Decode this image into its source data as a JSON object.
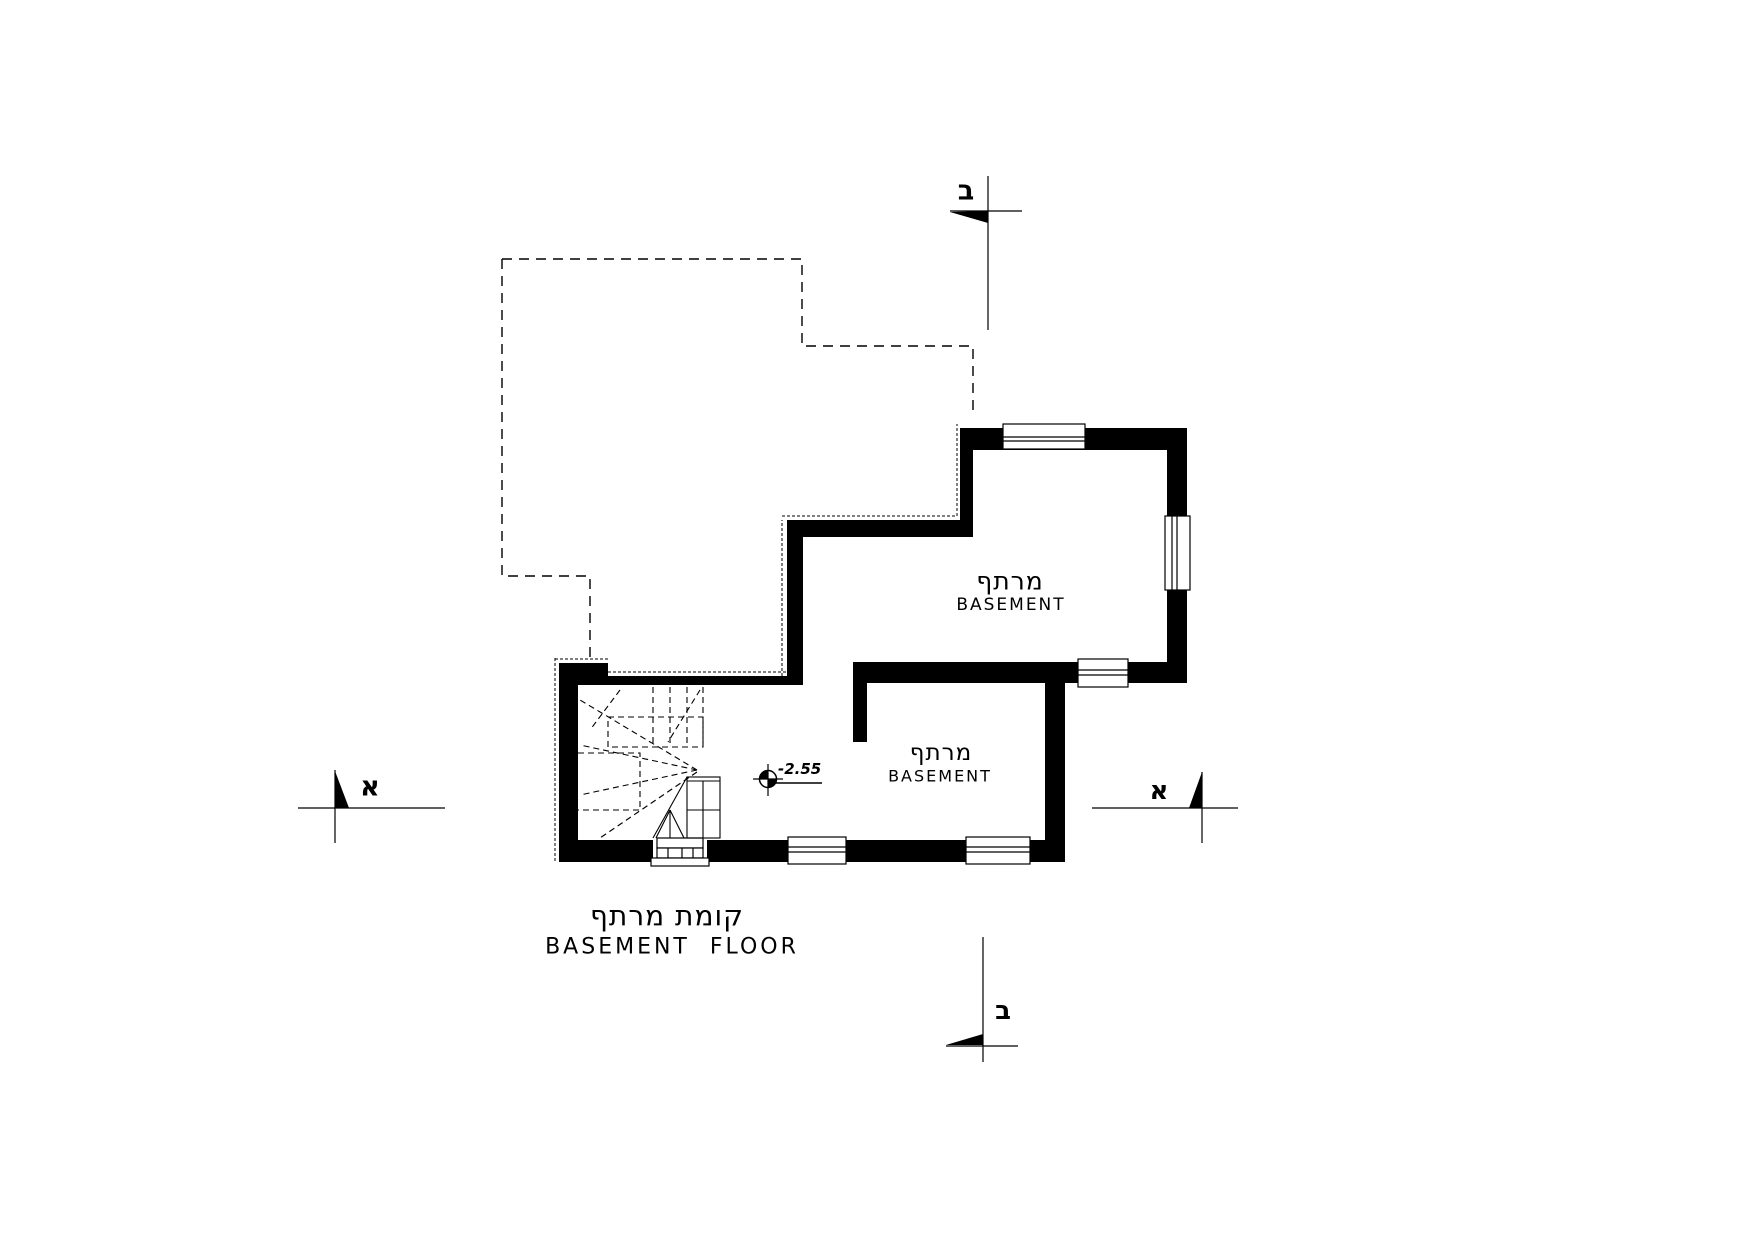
{
  "drawing": {
    "title_he": "קומת מרתף",
    "title_en": "BASEMENT  FLOOR",
    "rooms": [
      {
        "name_he": "מרתף",
        "name_en": "BASEMENT"
      },
      {
        "name_he": "מרתף",
        "name_en": "BASEMENT"
      }
    ],
    "level_marker": {
      "value": "-2.55"
    },
    "section_markers": {
      "top": "ב",
      "bottom": "ב",
      "left": "א",
      "right": "א"
    },
    "colors": {
      "ink": "#000000",
      "paper": "#ffffff"
    }
  }
}
